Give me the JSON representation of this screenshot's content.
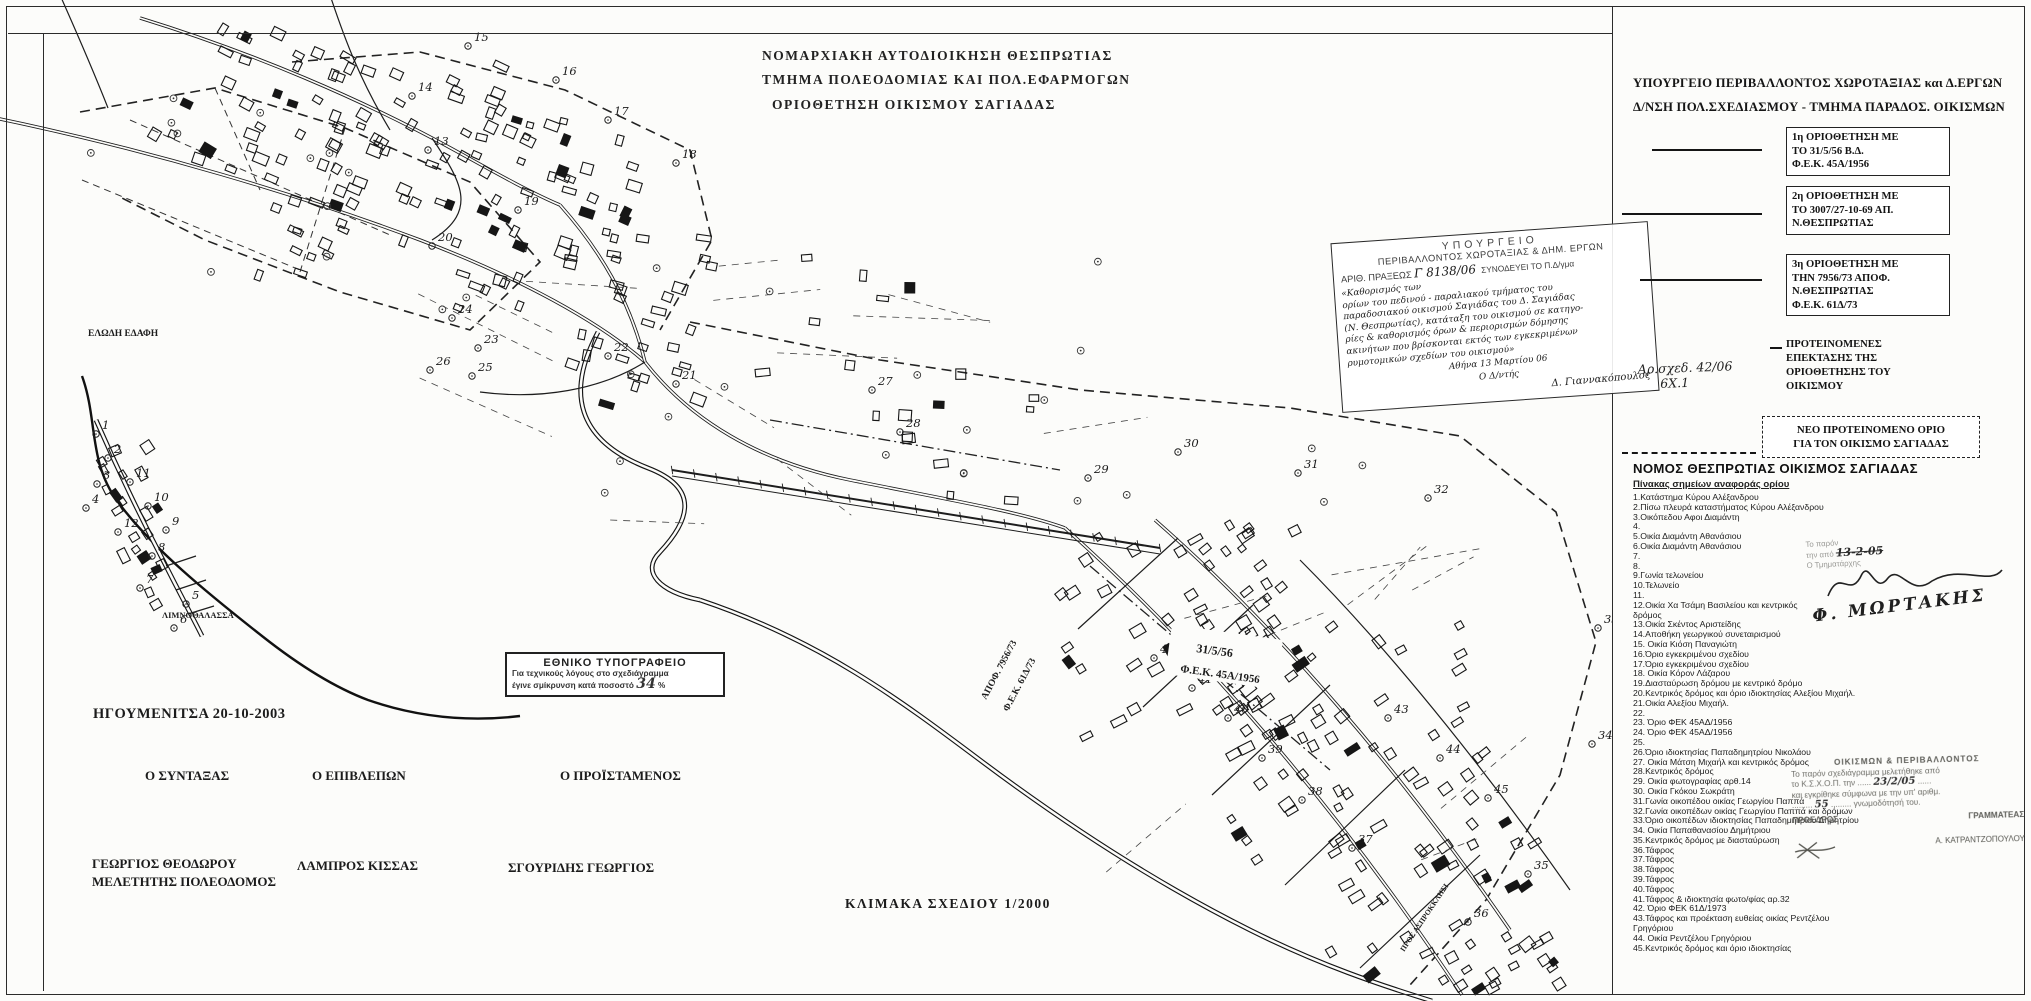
{
  "title_block": {
    "line1": "ΝΟΜΑΡΧΙΑΚΗ  ΑΥΤΟΔΙΟΙΚΗΣΗ  ΘΕΣΠΡΩΤΙΑΣ",
    "line2": "ΤΜΗΜΑ  ΠΟΛΕΟΔΟΜΙΑΣ  ΚΑΙ  ΠΟΛ.ΕΦΑΡΜΟΓΩΝ",
    "line3": "ΟΡΙΟΘΕΤΗΣΗ   ΟΙΚΙΣΜΟΥ  ΣΑΓΙΑΔΑΣ"
  },
  "panel": {
    "header1": "ΥΠΟΥΡΓΕΙΟ  ΠΕΡΙΒΑΛΛΟΝΤΟΣ  ΧΩΡΟΤΑΞΙΑΣ και Δ.ΕΡΓΩΝ",
    "header2": "Δ/ΝΣΗ ΠΟΛ.ΣΧΕΔΙΑΣΜΟΥ - ΤΜΗΜΑ ΠΑΡΑΔΟΣ. ΟΙΚΙΣΜΩΝ",
    "legend": [
      {
        "lines": [
          "1η ΟΡΙΟΘΕΤΗΣΗ ΜΕ",
          "ΤΟ 31/5/56 Β.Δ.",
          "Φ.Ε.Κ. 45Α/1956"
        ]
      },
      {
        "lines": [
          "2η ΟΡΙΟΘΕΤΗΣΗ ΜΕ",
          "ΤΟ 3007/27-10-69 ΑΠ.",
          "Ν.ΘΕΣΠΡΩΤΙΑΣ"
        ]
      },
      {
        "lines": [
          "3η ΟΡΙΟΘΕΤΗΣΗ ΜΕ",
          "ΤΗΝ 7956/73  ΑΠΟΦ.",
          "Ν.ΘΕΣΠΡΩΤΙΑΣ",
          "Φ.Ε.Κ. 61Δ/73"
        ]
      },
      {
        "lines": [
          "ΠΡΟΤΕΙΝΟΜΕΝΕΣ",
          "ΕΠΕΚΤΑΣΗΣ ΤΗΣ",
          "ΟΡΙΟΘΕΤΗΣΗΣ ΤΟΥ",
          "ΟΙΚΙΣΜΟΥ"
        ]
      }
    ],
    "drawing_no_line1": "Αρ.σχεδ. 42/06",
    "drawing_no_line2": "6Χ.1",
    "new_boundary_line1": "ΝΕΟ  ΠΡΟΤΕΙΝΟΜΕΝΟ  ΟΡΙΟ",
    "new_boundary_line2": "ΓΙΑ ΤΟΝ ΟΙΚΙΣΜΟ  ΣΑΓΙΑΔΑΣ",
    "table_title": "ΝΟΜΟΣ ΘΕΣΠΡΩΤΙΑΣ   ΟΙΚΙΣΜΟΣ ΣΑΓΙΑΔΑΣ",
    "table_subtitle": "Πίνακας σημείων αναφοράς ορίου",
    "points": [
      "1.Κατάστημα Κύρου Αλέξανδρου",
      "2.Πίσω πλευρά καταστήματος Κύρου Αλέξανδρου",
      "3.Οικόπεδου Αφοι Διαμάντη",
      "4.",
      "5.Οικία Διαμάντη Αθανάσιου",
      "6.Οικία Διαμάντη Αθανάσιου",
      "7.",
      "8.",
      "9.Γωνία τελωνείου",
      "10.Τελωνείο",
      "11.",
      "12.Οικία Χα Τσάμη Βασιλείου και κεντρικός\nδρόμος",
      "13.Οικία Σκέντος Αριστείδης",
      "14.Αποθήκη γεωργικού συνεταιρισμού",
      "15. Οικία Κιόση Παναγιώτη",
      "16.Όριο εγκεκριμένου σχεδίου",
      "17.Όριο εγκεκριμένου σχεδίου",
      "18. Οικία Κόρον Λάζαρου",
      "19.Διασταύρωση δρόμου με κεντρικό δρόμο",
      "20.Κεντρικός δρόμος και όριο ιδιοκτησίας Αλεξίου Μιχαήλ.",
      "21.Οικία Αλεξίου Μιχαήλ.",
      "22.",
      "23. Όριο ΦΕΚ 45ΑΔ/1956",
      "24. Όριο ΦΕΚ 45ΑΔ/1956",
      "25.",
      "26.Όριο ιδιοκτησίας Παπαδημητρίου Νικολάου",
      "27. Οικία Μάτση Μιχαήλ και κεντρικός δρόμος",
      "28.Κεντρικός δρόμος",
      "29. Οικία  φωτογραφίας  αρθ.14",
      "30. Οικία Γκόκου Σωκράτη",
      "31.Γωνία οικοπέδου οικίας Γεωργίου Παππά",
      "32.Γωνία οικοπέδων οικίας Γεωργίου Παππά και δρόμων",
      "33.Όριο οικοπέδων ιδιοκτησίας Παπαδημητρίου Δημητρίου",
      "34. Οικία Παπαθανασίου Δημήτριου",
      "35.Κεντρικός δρόμος με διασταύρωση",
      "36.Τάφρος",
      "37.Τάφρος",
      "38.Τάφρος",
      "39.Τάφρος",
      "40.Τάφρος",
      "41.Τάφρος & ιδιοκτησία φωτο/φίας αρ.32",
      "42. Όριο ΦΕΚ 61Δ/1973",
      "43.Τάφρος και προέκταση ευθείας οικίας Ρεντζέλου\nΓρηγόριου",
      "44. Οικία Ρεντζέλου Γρηγόριου",
      "45.Κεντρικός δρόμος και όριο ιδιοκτησίας"
    ],
    "note_line1": "Το παρόν",
    "note_line2a": "την από",
    "note_date": "13-2-05",
    "note_line3": "Ο Τμηματάρχης",
    "signature": "Φ. ΜΩΡΤΑΚΗΣ",
    "stamp": {
      "header": "ΟΙΚΙΣΜΩΝ & ΠΕΡΙΒΑΛΛΟΝΤΟΣ",
      "l1": "Το παρόν σχεδιάγραμμα μελετήθηκε από",
      "l2": "το Κ.Σ.Χ.Ο.Π. την",
      "date": "23/2/05",
      "l3": "και εγκρίθηκε σύμφωνα με την υπ' αριθμ.",
      "num": "55",
      "l4": "γνωμοδότησή του.",
      "role_left": "ΠΡΟΕΔΡΟΣ",
      "role_right": "ΓΡΑΜΜΑΤΕΑΣ",
      "name_right": "Α. ΚΑΤΡΑΝΤΖΟΠΟΥΛΟΥ"
    }
  },
  "map": {
    "stamp": {
      "t1": "ΥΠΟΥΡΓΕΙΟ",
      "t2": "ΠΕΡΙΒΑΛΛΟΝΤΟΣ  ΧΩΡΟΤΑΞΙΑΣ  &  ΔΗΜ. ΕΡΓΩΝ",
      "t3": "ΑΡΙΘ. ΠΡΑΞΕΩΣ",
      "t3_no": "Γ 8138/06",
      "t4": "ΣΥΝΟΔΕΥΕΙ ΤΟ Π.Δ/γμα",
      "hw": [
        "«Καθορισμός των",
        "ορίων του πεδινού - παραλιακού τμήματος του",
        "παραδοσιακού οικισμού Σαγιάδας του Δ. Σαγιάδας",
        "(Ν. Θεσπρωτίας), κατάταξη του οικισμού σε κατηγο-",
        "ρίες & καθορισμός όρων & περιορισμών δόμησης",
        "ακινήτων που βρίσκονται εκτός των εγκεκριμένων",
        "ρυμοτομικών σχεδίων του οικισμού»"
      ],
      "place_date": "Αθήνα  13 Μαρτίου 06",
      "role": "Ο Δ/ντής",
      "sig": "Δ. Γιαννακόπουλος"
    },
    "labels": [
      {
        "t": "ΕΛΩΔΗ ΕΔΑΦΗ",
        "x": 88,
        "y": 336,
        "r": 0,
        "s": 9.5
      },
      {
        "t": "ΛΙΜΝΟΘΑΛΑΣΣΑ",
        "x": 162,
        "y": 618,
        "r": 0,
        "s": 8.5
      },
      {
        "t": "31/5/56",
        "x": 1196,
        "y": 652,
        "r": 8,
        "s": 12
      },
      {
        "t": "Φ.Ε.Κ. 45Α/1956",
        "x": 1180,
        "y": 672,
        "r": 8,
        "s": 11
      },
      {
        "t": "ΑΠΟΦ. 7956/73",
        "x": 986,
        "y": 700,
        "r": -62,
        "s": 9.5
      },
      {
        "t": "Φ.Ε.Κ. 61Δ/73",
        "x": 1008,
        "y": 712,
        "r": -62,
        "s": 9.5
      },
      {
        "t": "ΠΡΟΣ ΑΣΠΡΟΚΚΛΗΣΙ",
        "x": 1404,
        "y": 952,
        "r": -56,
        "s": 7.5
      }
    ],
    "markers": [
      {
        "n": "1",
        "x": 96,
        "y": 434
      },
      {
        "n": "2",
        "x": 108,
        "y": 458
      },
      {
        "n": "3",
        "x": 97,
        "y": 484
      },
      {
        "n": "4",
        "x": 86,
        "y": 508
      },
      {
        "n": "5",
        "x": 186,
        "y": 604
      },
      {
        "n": "6",
        "x": 174,
        "y": 628
      },
      {
        "n": "7",
        "x": 140,
        "y": 588
      },
      {
        "n": "8",
        "x": 152,
        "y": 556
      },
      {
        "n": "9",
        "x": 166,
        "y": 530
      },
      {
        "n": "10",
        "x": 148,
        "y": 506
      },
      {
        "n": "11",
        "x": 130,
        "y": 482
      },
      {
        "n": "12",
        "x": 118,
        "y": 532
      },
      {
        "n": "13",
        "x": 428,
        "y": 150
      },
      {
        "n": "14",
        "x": 412,
        "y": 96
      },
      {
        "n": "15",
        "x": 468,
        "y": 46
      },
      {
        "n": "16",
        "x": 556,
        "y": 80
      },
      {
        "n": "17",
        "x": 608,
        "y": 120
      },
      {
        "n": "18",
        "x": 676,
        "y": 163
      },
      {
        "n": "19",
        "x": 518,
        "y": 210
      },
      {
        "n": "20",
        "x": 432,
        "y": 246
      },
      {
        "n": "21",
        "x": 676,
        "y": 384
      },
      {
        "n": "22",
        "x": 608,
        "y": 356
      },
      {
        "n": "23",
        "x": 478,
        "y": 348
      },
      {
        "n": "24",
        "x": 452,
        "y": 318
      },
      {
        "n": "25",
        "x": 472,
        "y": 376
      },
      {
        "n": "26",
        "x": 430,
        "y": 370
      },
      {
        "n": "27",
        "x": 872,
        "y": 390
      },
      {
        "n": "28",
        "x": 900,
        "y": 432
      },
      {
        "n": "29",
        "x": 1088,
        "y": 478
      },
      {
        "n": "30",
        "x": 1178,
        "y": 452
      },
      {
        "n": "31",
        "x": 1298,
        "y": 473
      },
      {
        "n": "32",
        "x": 1428,
        "y": 498
      },
      {
        "n": "33",
        "x": 1598,
        "y": 628
      },
      {
        "n": "34",
        "x": 1592,
        "y": 744
      },
      {
        "n": "35",
        "x": 1528,
        "y": 874
      },
      {
        "n": "36",
        "x": 1468,
        "y": 922
      },
      {
        "n": "37",
        "x": 1352,
        "y": 848
      },
      {
        "n": "38",
        "x": 1302,
        "y": 800
      },
      {
        "n": "39",
        "x": 1262,
        "y": 758
      },
      {
        "n": "40",
        "x": 1228,
        "y": 718
      },
      {
        "n": "41",
        "x": 1192,
        "y": 688
      },
      {
        "n": "42",
        "x": 1154,
        "y": 658
      },
      {
        "n": "43",
        "x": 1388,
        "y": 718
      },
      {
        "n": "44",
        "x": 1440,
        "y": 758
      },
      {
        "n": "45",
        "x": 1488,
        "y": 798
      }
    ],
    "scale": "ΚΛΙΜΑΚΑ  ΣΧΕΔΙΟΥ 1/2000"
  },
  "sign_block": {
    "place_date": "ΗΓΟΥΜΕΝΙΤΣΑ  20-10-2003",
    "role1": "Ο ΣΥΝΤΑΞΑΣ",
    "role2": "Ο ΕΠΙΒΛΕΠΩΝ",
    "role3": "Ο ΠΡΟΪΣΤΑΜΕΝΟΣ",
    "name1": "ΓΕΩΡΓΙΟΣ ΘΕΟΔΩΡΟΥ",
    "name1_sub": "ΜΕΛΕΤΗΤΗΣ ΠΟΛΕΟΔΟΜΟΣ",
    "name2": "ΛΑΜΠΡΟΣ ΚΙΣΣΑΣ",
    "name3": "ΣΓΟΥΡΙΔΗΣ ΓΕΩΡΓΙΟΣ"
  },
  "print_stamp": {
    "title": "ΕΘΝΙΚΟ ΤΥΠΟΓΡΑΦΕΙΟ",
    "l1": "Για τεχνικούς λόγους στο σχεδιάγραμμα",
    "l2": "έγινε σμίκρυνση κατά ποσοστό",
    "pct": "34",
    "pct_unit": "%"
  }
}
